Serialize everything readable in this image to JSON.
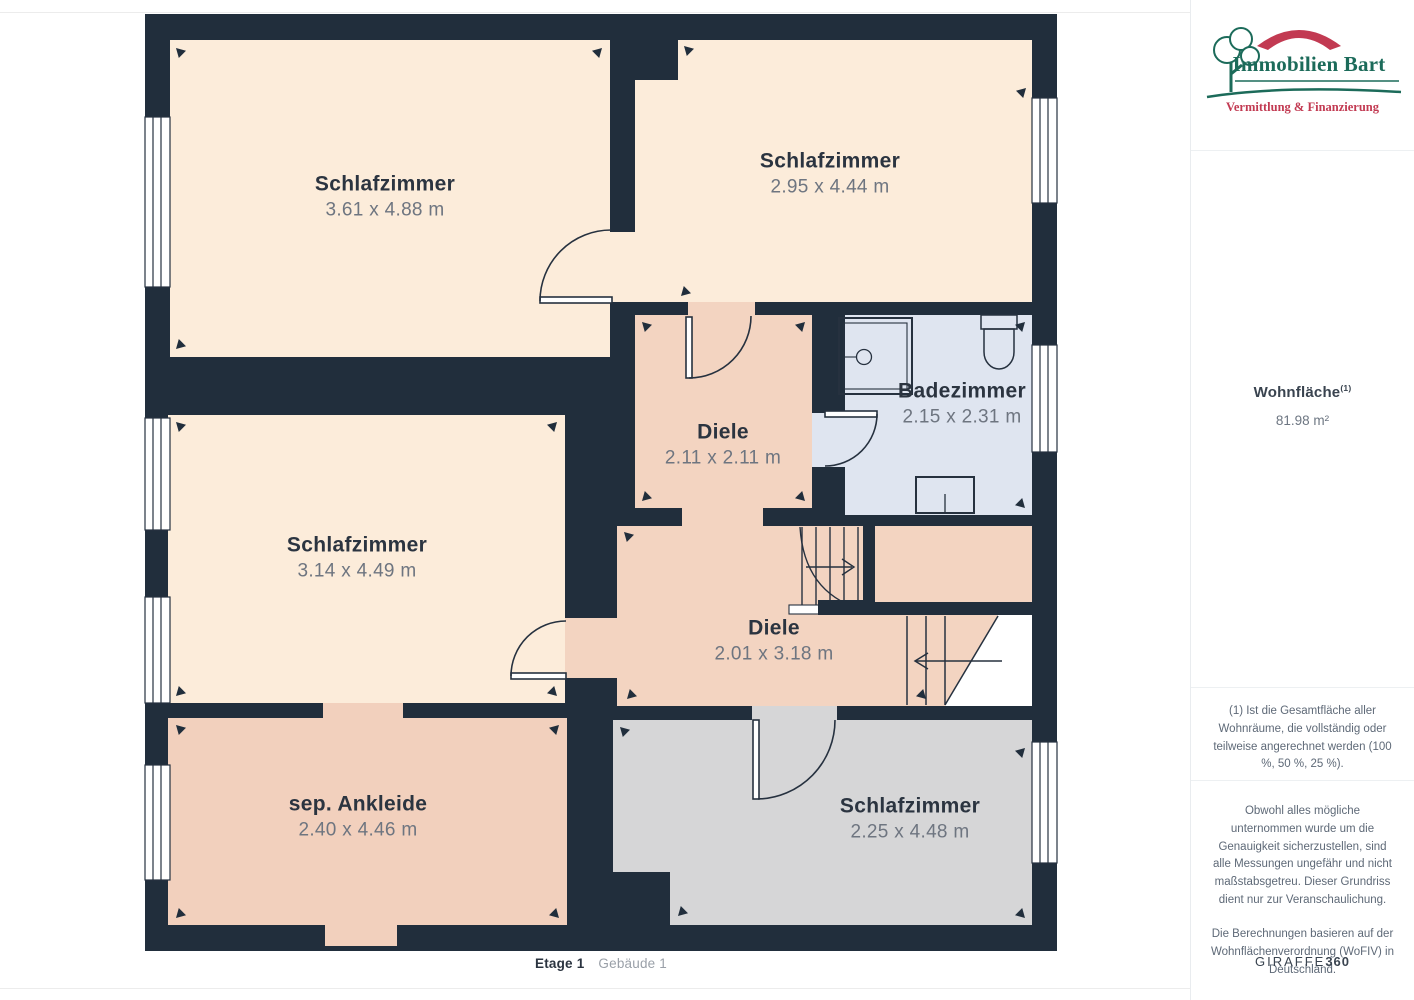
{
  "floorplan": {
    "rooms": [
      {
        "name": "Schlafzimmer",
        "dims": "3.61 x 4.88 m"
      },
      {
        "name": "Schlafzimmer",
        "dims": "2.95 x 4.44 m"
      },
      {
        "name": "Badezimmer",
        "dims": "2.15 x 2.31 m"
      },
      {
        "name": "Diele",
        "dims": "2.11 x 2.11 m"
      },
      {
        "name": "Schlafzimmer",
        "dims": "3.14 x 4.49 m"
      },
      {
        "name": "Diele",
        "dims": "2.01 x 3.18 m"
      },
      {
        "name": "sep. Ankleide",
        "dims": "2.40 x 4.46 m"
      },
      {
        "name": "Schlafzimmer",
        "dims": "2.25 x 4.48 m"
      }
    ],
    "footer": {
      "floor": "Etage 1",
      "building": "Gebäude 1"
    }
  },
  "sidebar": {
    "logo": {
      "name": "Immobilien Bart",
      "tagline": "Vermittlung & Finanzierung"
    },
    "area": {
      "label": "Wohnfläche",
      "superscript": "(1)",
      "value": "81.98 m²"
    },
    "notes": [
      "(1) Ist die Gesamtfläche aller Wohnräume, die vollständig oder teilweise angerechnet werden (100 %, 50 %, 25 %).",
      "Obwohl alles mögliche unternommen wurde um die Genauigkeit sicherzustellen, sind alle Messungen ungefähr und nicht maßstabsgetreu. Dieser Grundriss dient nur zur Veranschaulichung.",
      "Die Berechnungen basieren auf der Wohnflächenverordnung (WoFIV) in Deutschland."
    ],
    "brand": {
      "name": "GIRAFFE",
      "suffix": "360"
    }
  },
  "colors": {
    "wall": "#212e3c",
    "room_light": "#fcecda",
    "room_tan": "#f3d4c1",
    "bathroom": "#dfe5f0",
    "room_grey": "#d6d6d7",
    "logo_green": "#1c6b5a",
    "logo_red": "#c23a52"
  }
}
